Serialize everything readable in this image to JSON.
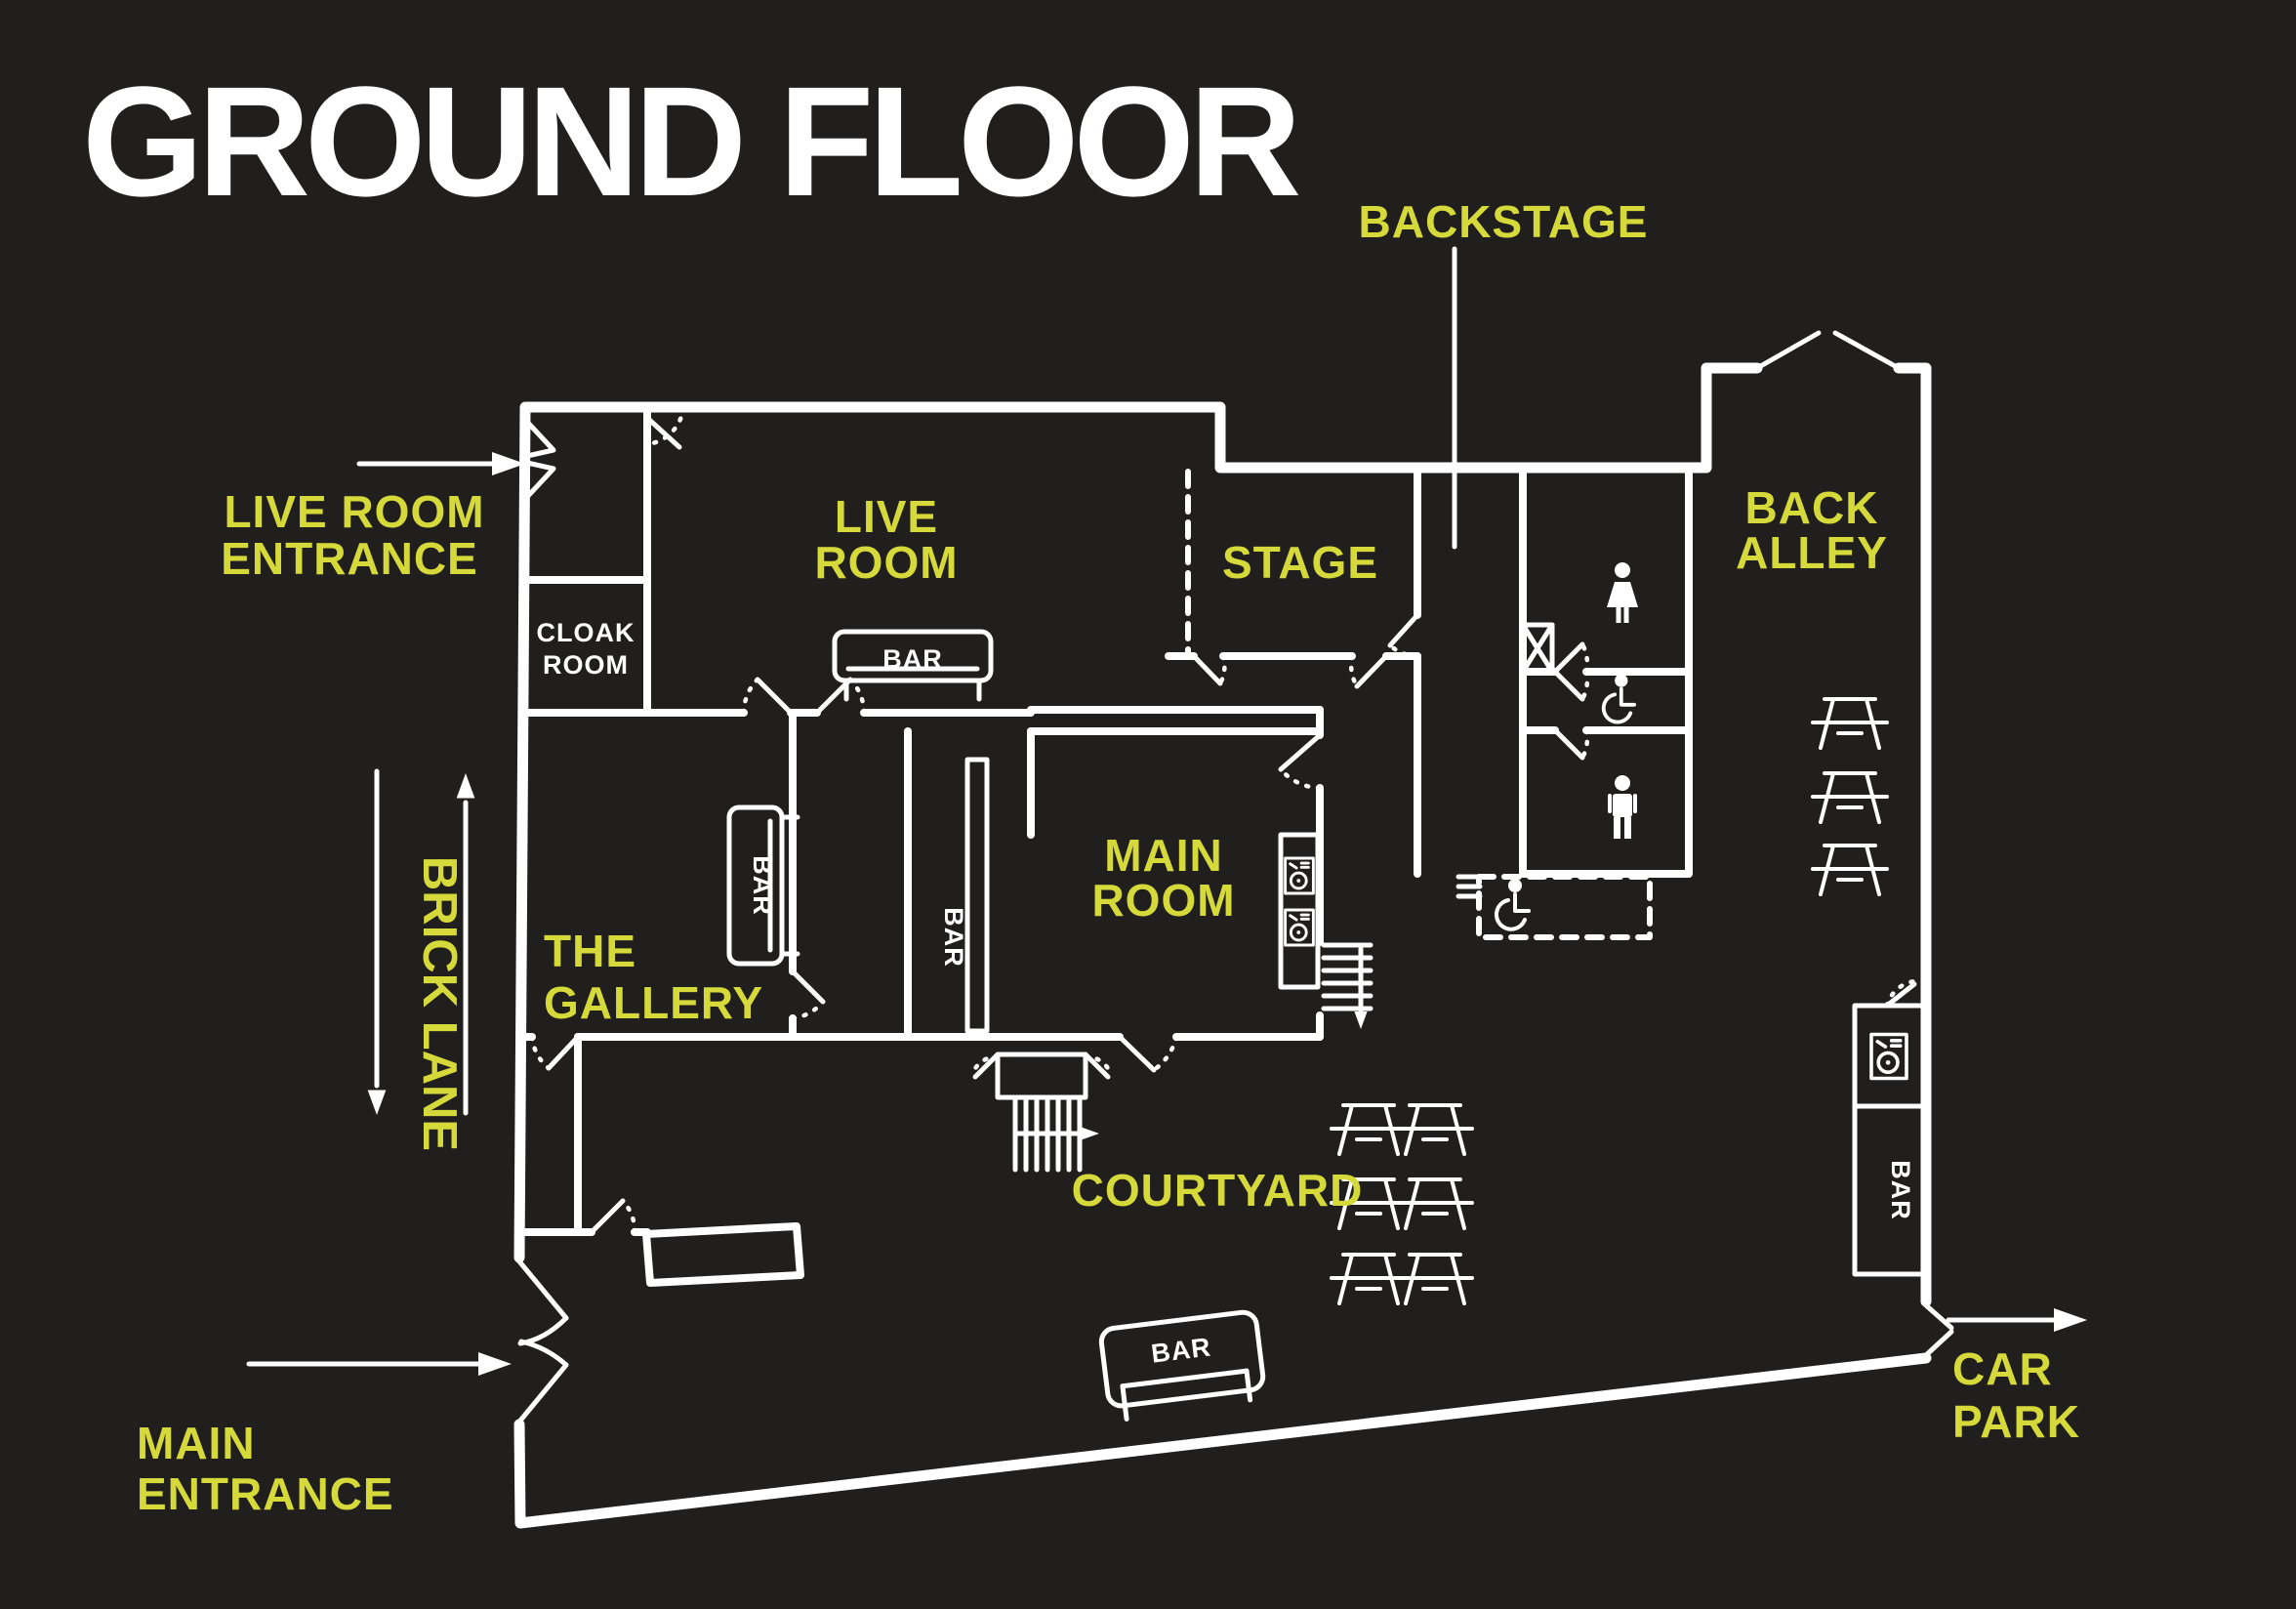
{
  "title": "GROUND FLOOR",
  "colors": {
    "background": "#211e1e",
    "accent": "#d5d93a",
    "line": "#ffffff"
  },
  "labels": {
    "backstage": "BACKSTAGE",
    "live_room_entrance": {
      "line1": "LIVE ROOM",
      "line2": "ENTRANCE"
    },
    "live_room": {
      "line1": "LIVE",
      "line2": "ROOM"
    },
    "cloak_room": {
      "line1": "CLOAK",
      "line2": "ROOM"
    },
    "stage": "STAGE",
    "back_alley": {
      "line1": "BACK",
      "line2": "ALLEY"
    },
    "brick_lane": "BRICK LANE",
    "the_gallery": {
      "line1": "THE",
      "line2": "GALLERY"
    },
    "main_room": {
      "line1": "MAIN",
      "line2": "ROOM"
    },
    "courtyard": "COURTYARD",
    "main_entrance": {
      "line1": "MAIN",
      "line2": "ENTRANCE"
    },
    "car_park": {
      "line1": "CAR",
      "line2": "PARK"
    },
    "bar": "BAR"
  },
  "icons": {
    "picnic_table": "picnic-table-icon",
    "female_toilet": "female-toilet-icon",
    "male_toilet": "male-toilet-icon",
    "accessible_toilet": "accessible-toilet-icon",
    "dj_decks": "dj-decks-icon",
    "stairs": "stairs-icon",
    "direction_arrow": "arrow-icon"
  },
  "furniture": {
    "back_alley_picnic_tables": 3,
    "courtyard_picnic_tables": 6,
    "bar_counters": 5,
    "dj_booths": 3
  }
}
